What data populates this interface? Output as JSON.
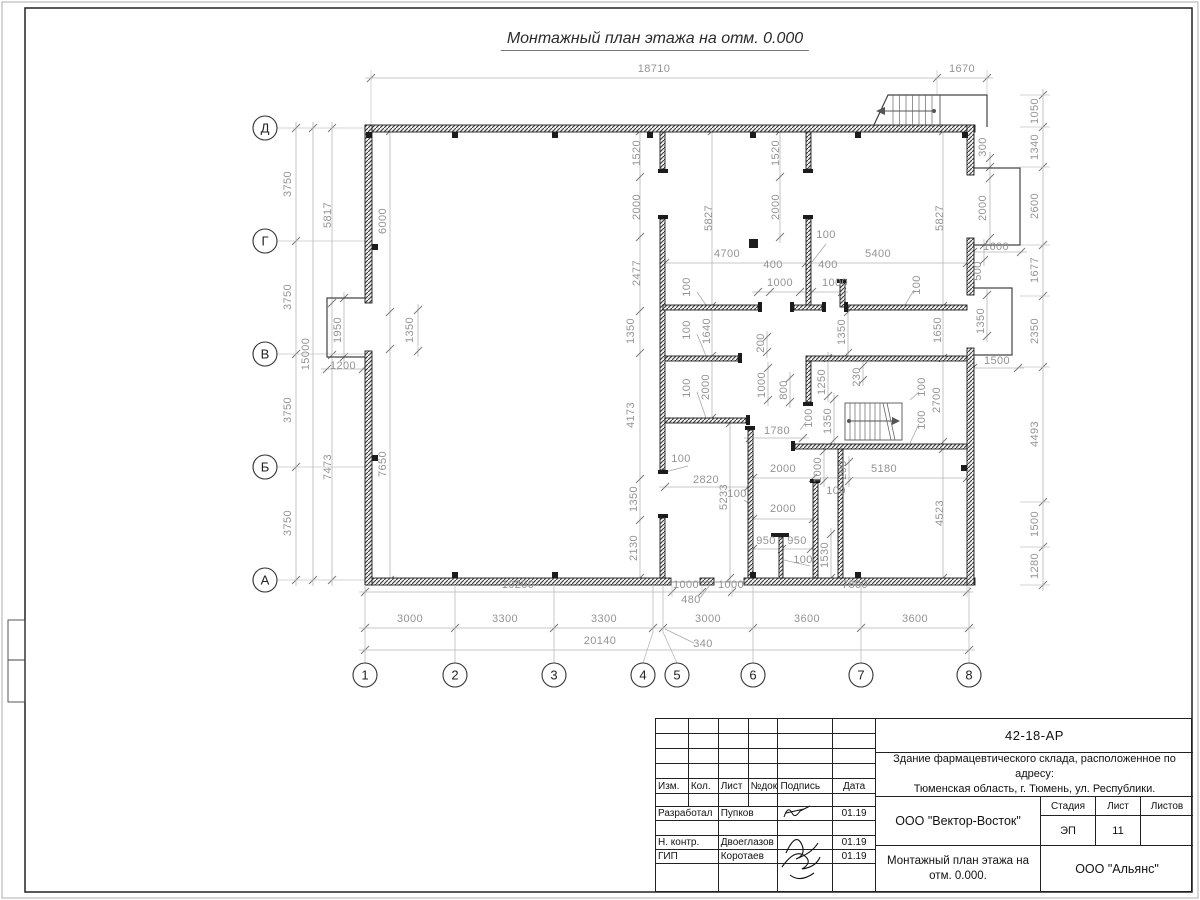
{
  "colors": {
    "wall": "#1c1c1c",
    "dim_text": "#949494",
    "dim_line": "#b5b5b5",
    "tick": "#7a7a7a",
    "axis_text": "#222222",
    "frame": "#222222"
  },
  "sheet": {
    "title": "Монтажный план этажа на отм. 0.000",
    "code": "42-18-АР",
    "object_line1": "Здание фармацевтического склада, расположенное по адресу:",
    "object_line2": "Тюменская область, г. Тюмень, ул. Республики.",
    "developer_org": "ООО \"Вектор-Восток\"",
    "customer_org": "ООО \"Альянс\"",
    "drawing_name_line1": "Монтажный план этажа на",
    "drawing_name_line2": "отм. 0.000.",
    "stage_label": "Стадия",
    "sheet_label": "Лист",
    "sheets_label": "Листов",
    "stage_value": "ЭП",
    "sheet_value": "11",
    "sheets_value": "",
    "header_cols": [
      "Изм.",
      "Кол.",
      "Лист",
      "№док.",
      "Подпись",
      "Дата"
    ],
    "roles": [
      {
        "role": "Разработал",
        "name": "Пупков",
        "date": "01.19"
      },
      {
        "role": "Н. контр.",
        "name": "Двоеглазов",
        "date": "01.19"
      },
      {
        "role": "ГИП",
        "name": "Коротаев",
        "date": "01.19"
      }
    ]
  },
  "axes": {
    "rows": [
      {
        "label": "Д",
        "y": 128
      },
      {
        "label": "Г",
        "y": 241
      },
      {
        "label": "В",
        "y": 354
      },
      {
        "label": "Б",
        "y": 467
      },
      {
        "label": "А",
        "y": 580
      }
    ],
    "cols": [
      {
        "label": "1",
        "x": 365,
        "tx": 365
      },
      {
        "label": "2",
        "x": 455,
        "tx": 455
      },
      {
        "label": "3",
        "x": 554,
        "tx": 554
      },
      {
        "label": "4",
        "x": 643,
        "tx": 653
      },
      {
        "label": "5",
        "x": 677,
        "tx": 663
      },
      {
        "label": "6",
        "x": 753,
        "tx": 753
      },
      {
        "label": "7",
        "x": 861,
        "tx": 861
      },
      {
        "label": "8",
        "x": 969,
        "tx": 969
      }
    ]
  },
  "dimensions": [
    {
      "t": "18710",
      "x": 654,
      "y": 72,
      "r": 0
    },
    {
      "t": "1670",
      "x": 962,
      "y": 72,
      "r": 0
    },
    {
      "t": "3750",
      "x": 291,
      "y": 184,
      "r": -90
    },
    {
      "t": "3750",
      "x": 291,
      "y": 297,
      "r": -90
    },
    {
      "t": "3750",
      "x": 291,
      "y": 410,
      "r": -90
    },
    {
      "t": "3750",
      "x": 291,
      "y": 523,
      "r": -90
    },
    {
      "t": "15000",
      "x": 309,
      "y": 354,
      "r": -90
    },
    {
      "t": "5817",
      "x": 331,
      "y": 215,
      "r": -90
    },
    {
      "t": "7473",
      "x": 331,
      "y": 467,
      "r": -90
    },
    {
      "t": "1950",
      "x": 341,
      "y": 330,
      "r": -90
    },
    {
      "t": "1200",
      "x": 343,
      "y": 369,
      "r": 0
    },
    {
      "t": "1350",
      "x": 413,
      "y": 330,
      "r": -90
    },
    {
      "t": "6000",
      "x": 386,
      "y": 221,
      "r": -90
    },
    {
      "t": "7650",
      "x": 386,
      "y": 464,
      "r": -90
    },
    {
      "t": "1050",
      "x": 1038,
      "y": 111,
      "r": -90
    },
    {
      "t": "1340",
      "x": 1038,
      "y": 147,
      "r": -90
    },
    {
      "t": "2600",
      "x": 1038,
      "y": 206,
      "r": -90
    },
    {
      "t": "1677",
      "x": 1038,
      "y": 270,
      "r": -90
    },
    {
      "t": "2350",
      "x": 1038,
      "y": 331,
      "r": -90
    },
    {
      "t": "4493",
      "x": 1038,
      "y": 434,
      "r": -90
    },
    {
      "t": "1500",
      "x": 1038,
      "y": 524,
      "r": -90
    },
    {
      "t": "1280",
      "x": 1038,
      "y": 566,
      "r": -90
    },
    {
      "t": "300",
      "x": 986,
      "y": 147,
      "r": -90
    },
    {
      "t": "2000",
      "x": 986,
      "y": 208,
      "r": -90
    },
    {
      "t": "1600",
      "x": 996,
      "y": 250,
      "r": 0
    },
    {
      "t": "500",
      "x": 981,
      "y": 271,
      "r": -90
    },
    {
      "t": "1350",
      "x": 984,
      "y": 321,
      "r": -90
    },
    {
      "t": "1500",
      "x": 997,
      "y": 364,
      "r": 0
    },
    {
      "t": "10200",
      "x": 518,
      "y": 588,
      "r": 0
    },
    {
      "t": "1000",
      "x": 686,
      "y": 588,
      "r": 0
    },
    {
      "t": "1000",
      "x": 731,
      "y": 588,
      "r": 0
    },
    {
      "t": "7800",
      "x": 855,
      "y": 588,
      "r": 0
    },
    {
      "t": "480",
      "x": 691,
      "y": 603,
      "r": 0
    },
    {
      "t": "3000",
      "x": 410,
      "y": 622,
      "r": 0
    },
    {
      "t": "3300",
      "x": 505,
      "y": 622,
      "r": 0
    },
    {
      "t": "3300",
      "x": 604,
      "y": 622,
      "r": 0
    },
    {
      "t": "3000",
      "x": 708,
      "y": 622,
      "r": 0
    },
    {
      "t": "3600",
      "x": 807,
      "y": 622,
      "r": 0
    },
    {
      "t": "3600",
      "x": 915,
      "y": 622,
      "r": 0
    },
    {
      "t": "20140",
      "x": 600,
      "y": 644,
      "r": 0
    },
    {
      "t": "340",
      "x": 703,
      "y": 647,
      "r": 0
    },
    {
      "t": "1520",
      "x": 640,
      "y": 153,
      "r": -90
    },
    {
      "t": "2000",
      "x": 640,
      "y": 207,
      "r": -90
    },
    {
      "t": "2477",
      "x": 640,
      "y": 273,
      "r": -90
    },
    {
      "t": "1350",
      "x": 634,
      "y": 331,
      "r": -90
    },
    {
      "t": "4173",
      "x": 634,
      "y": 415,
      "r": -90
    },
    {
      "t": "1350",
      "x": 637,
      "y": 499,
      "r": -90
    },
    {
      "t": "2130",
      "x": 637,
      "y": 548,
      "r": -90
    },
    {
      "t": "5827",
      "x": 712,
      "y": 218,
      "r": -90
    },
    {
      "t": "1640",
      "x": 710,
      "y": 331,
      "r": -90
    },
    {
      "t": "2000",
      "x": 709,
      "y": 387,
      "r": -90
    },
    {
      "t": "1520",
      "x": 779,
      "y": 153,
      "r": -90
    },
    {
      "t": "2000",
      "x": 779,
      "y": 207,
      "r": -90
    },
    {
      "t": "1350",
      "x": 845,
      "y": 332,
      "r": -90
    },
    {
      "t": "5827",
      "x": 943,
      "y": 218,
      "r": -90
    },
    {
      "t": "1650",
      "x": 941,
      "y": 330,
      "r": -90
    },
    {
      "t": "2700",
      "x": 940,
      "y": 400,
      "r": -90
    },
    {
      "t": "4523",
      "x": 943,
      "y": 513,
      "r": -90
    },
    {
      "t": "4700",
      "x": 727,
      "y": 257,
      "r": 0
    },
    {
      "t": "5400",
      "x": 878,
      "y": 257,
      "r": 0
    },
    {
      "t": "400",
      "x": 773,
      "y": 268,
      "r": 0
    },
    {
      "t": "1000",
      "x": 780,
      "y": 286,
      "r": 0
    },
    {
      "t": "400",
      "x": 828,
      "y": 268,
      "r": 0
    },
    {
      "t": "1000",
      "x": 835,
      "y": 286,
      "r": 0
    },
    {
      "t": "1780",
      "x": 777,
      "y": 434,
      "r": 0
    },
    {
      "t": "2820",
      "x": 706,
      "y": 483,
      "r": 0
    },
    {
      "t": "2000",
      "x": 783,
      "y": 472,
      "r": 0
    },
    {
      "t": "5180",
      "x": 884,
      "y": 472,
      "r": 0
    },
    {
      "t": "2000",
      "x": 783,
      "y": 512,
      "r": 0
    },
    {
      "t": "950",
      "x": 766,
      "y": 544,
      "r": 0
    },
    {
      "t": "950",
      "x": 797,
      "y": 544,
      "r": 0
    },
    {
      "t": "5233",
      "x": 727,
      "y": 497,
      "r": -90
    },
    {
      "t": "1000",
      "x": 765,
      "y": 385,
      "r": -90
    },
    {
      "t": "800",
      "x": 787,
      "y": 390,
      "r": -90
    },
    {
      "t": "200",
      "x": 764,
      "y": 343,
      "r": -90
    },
    {
      "t": "1250",
      "x": 825,
      "y": 382,
      "r": -90
    },
    {
      "t": "1350",
      "x": 831,
      "y": 421,
      "r": -90
    },
    {
      "t": "230",
      "x": 860,
      "y": 377,
      "r": -90
    },
    {
      "t": "1000",
      "x": 821,
      "y": 470,
      "r": -90
    },
    {
      "t": "200",
      "x": 846,
      "y": 470,
      "r": -90
    },
    {
      "t": "1530",
      "x": 828,
      "y": 555,
      "r": -90
    },
    {
      "t": "100",
      "x": 826,
      "y": 238,
      "r": 0
    },
    {
      "t": "100",
      "x": 690,
      "y": 287,
      "r": -90
    },
    {
      "t": "100",
      "x": 690,
      "y": 330,
      "r": -90
    },
    {
      "t": "100",
      "x": 690,
      "y": 388,
      "r": -90
    },
    {
      "t": "100",
      "x": 920,
      "y": 285,
      "r": -90
    },
    {
      "t": "100",
      "x": 925,
      "y": 387,
      "r": -90
    },
    {
      "t": "100",
      "x": 925,
      "y": 420,
      "r": -90
    },
    {
      "t": "100",
      "x": 681,
      "y": 462,
      "r": 0
    },
    {
      "t": "100",
      "x": 737,
      "y": 497,
      "r": 0
    },
    {
      "t": "100",
      "x": 836,
      "y": 494,
      "r": 0
    },
    {
      "t": "100",
      "x": 803,
      "y": 563,
      "r": 0
    },
    {
      "t": "100",
      "x": 812,
      "y": 418,
      "r": -90
    }
  ]
}
